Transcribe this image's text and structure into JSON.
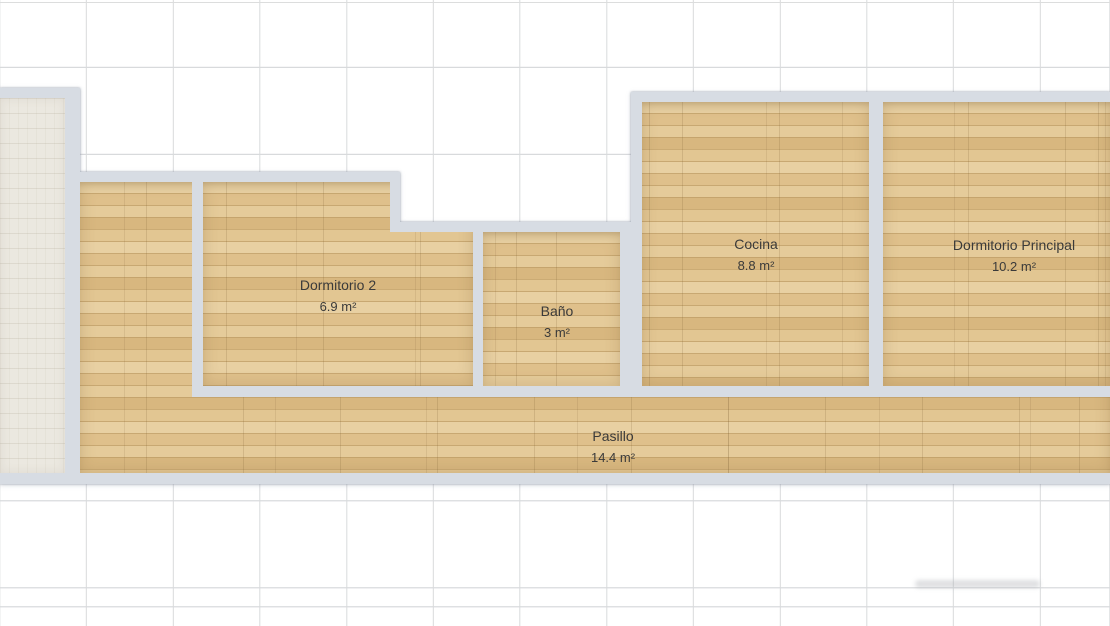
{
  "plan": {
    "rooms": [
      {
        "name": "Dormitorio 2",
        "area": "6.9 m²"
      },
      {
        "name": "Baño",
        "area": "3 m²"
      },
      {
        "name": "Cocina",
        "area": "8.8 m²"
      },
      {
        "name": "Dormitorio Principal",
        "area": "10.2 m²"
      },
      {
        "name": "Pasillo",
        "area": "14.4 m²"
      }
    ],
    "colors": {
      "wood_base": "#e2c692",
      "wood_row_dark": "#d8b77f",
      "plank_line": "#c8a872",
      "wall": "#d7dce3",
      "tile_floor": "#ebe8e0",
      "grid_line": "#d6d8da",
      "label_text": "#3a3a3a",
      "background": "#ffffff"
    }
  }
}
